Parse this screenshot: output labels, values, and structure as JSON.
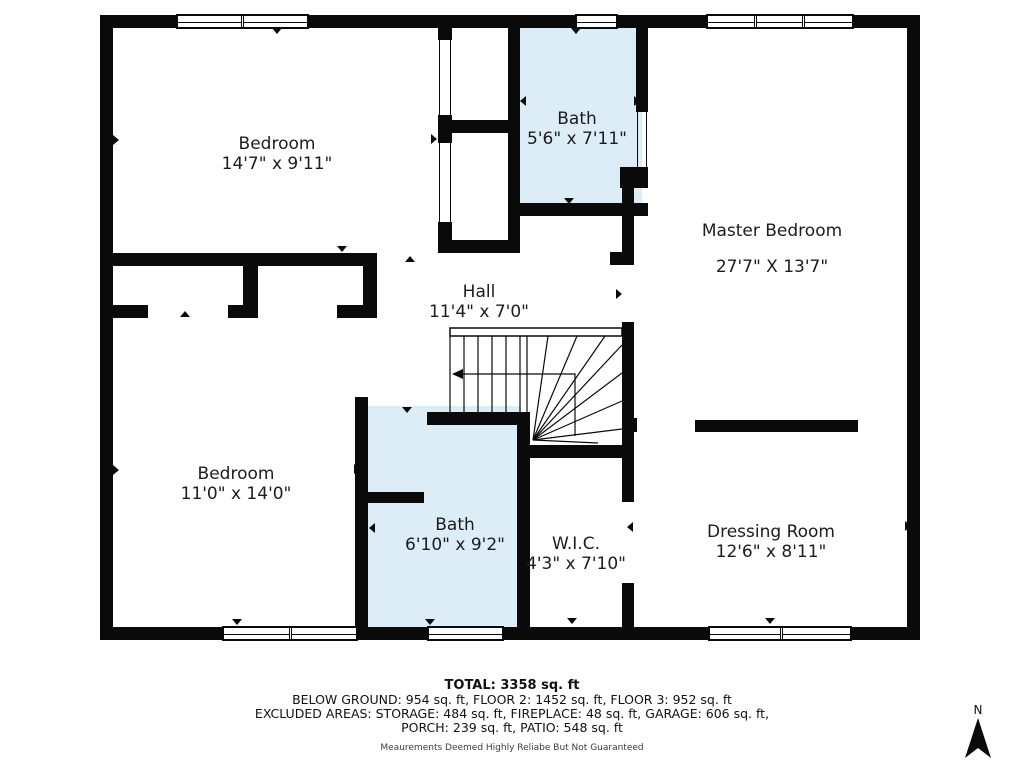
{
  "rooms": {
    "bedroom_top_left": {
      "name": "Bedroom",
      "dims": "14'7\" x 9'11\""
    },
    "bath_top": {
      "name": "Bath",
      "dims": "5'6\" x 7'11\""
    },
    "master_bedroom": {
      "name": "Master Bedroom",
      "dims": "27'7\" X 13'7\""
    },
    "hall": {
      "name": "Hall",
      "dims": "11'4\" x 7'0\""
    },
    "bedroom_bottom_left": {
      "name": "Bedroom",
      "dims": "11'0\" x 14'0\""
    },
    "bath_bottom": {
      "name": "Bath",
      "dims": "6'10\" x 9'2\""
    },
    "wic": {
      "name": "W.I.C.",
      "dims": "4'3\" x 7'10\""
    },
    "dressing_room": {
      "name": "Dressing Room",
      "dims": "12'6\" x 8'11\""
    }
  },
  "summary": {
    "total": "TOTAL: 3358 sq. ft",
    "line1": "BELOW GROUND: 954 sq. ft, FLOOR 2: 1452 sq. ft, FLOOR 3: 952 sq. ft",
    "line2": "EXCLUDED AREAS: STORAGE: 484 sq. ft, FIREPLACE: 48 sq. ft, GARAGE: 606 sq. ft,",
    "line3": "PORCH: 239 sq. ft, PATIO: 548 sq. ft",
    "disclaimer": "Meaurements Deemed Highly Reliabe But Not Guaranteed"
  },
  "compass": {
    "label": "N"
  },
  "colors": {
    "wall": "#0a0a0a",
    "bath_fill": "#ddedf8"
  }
}
